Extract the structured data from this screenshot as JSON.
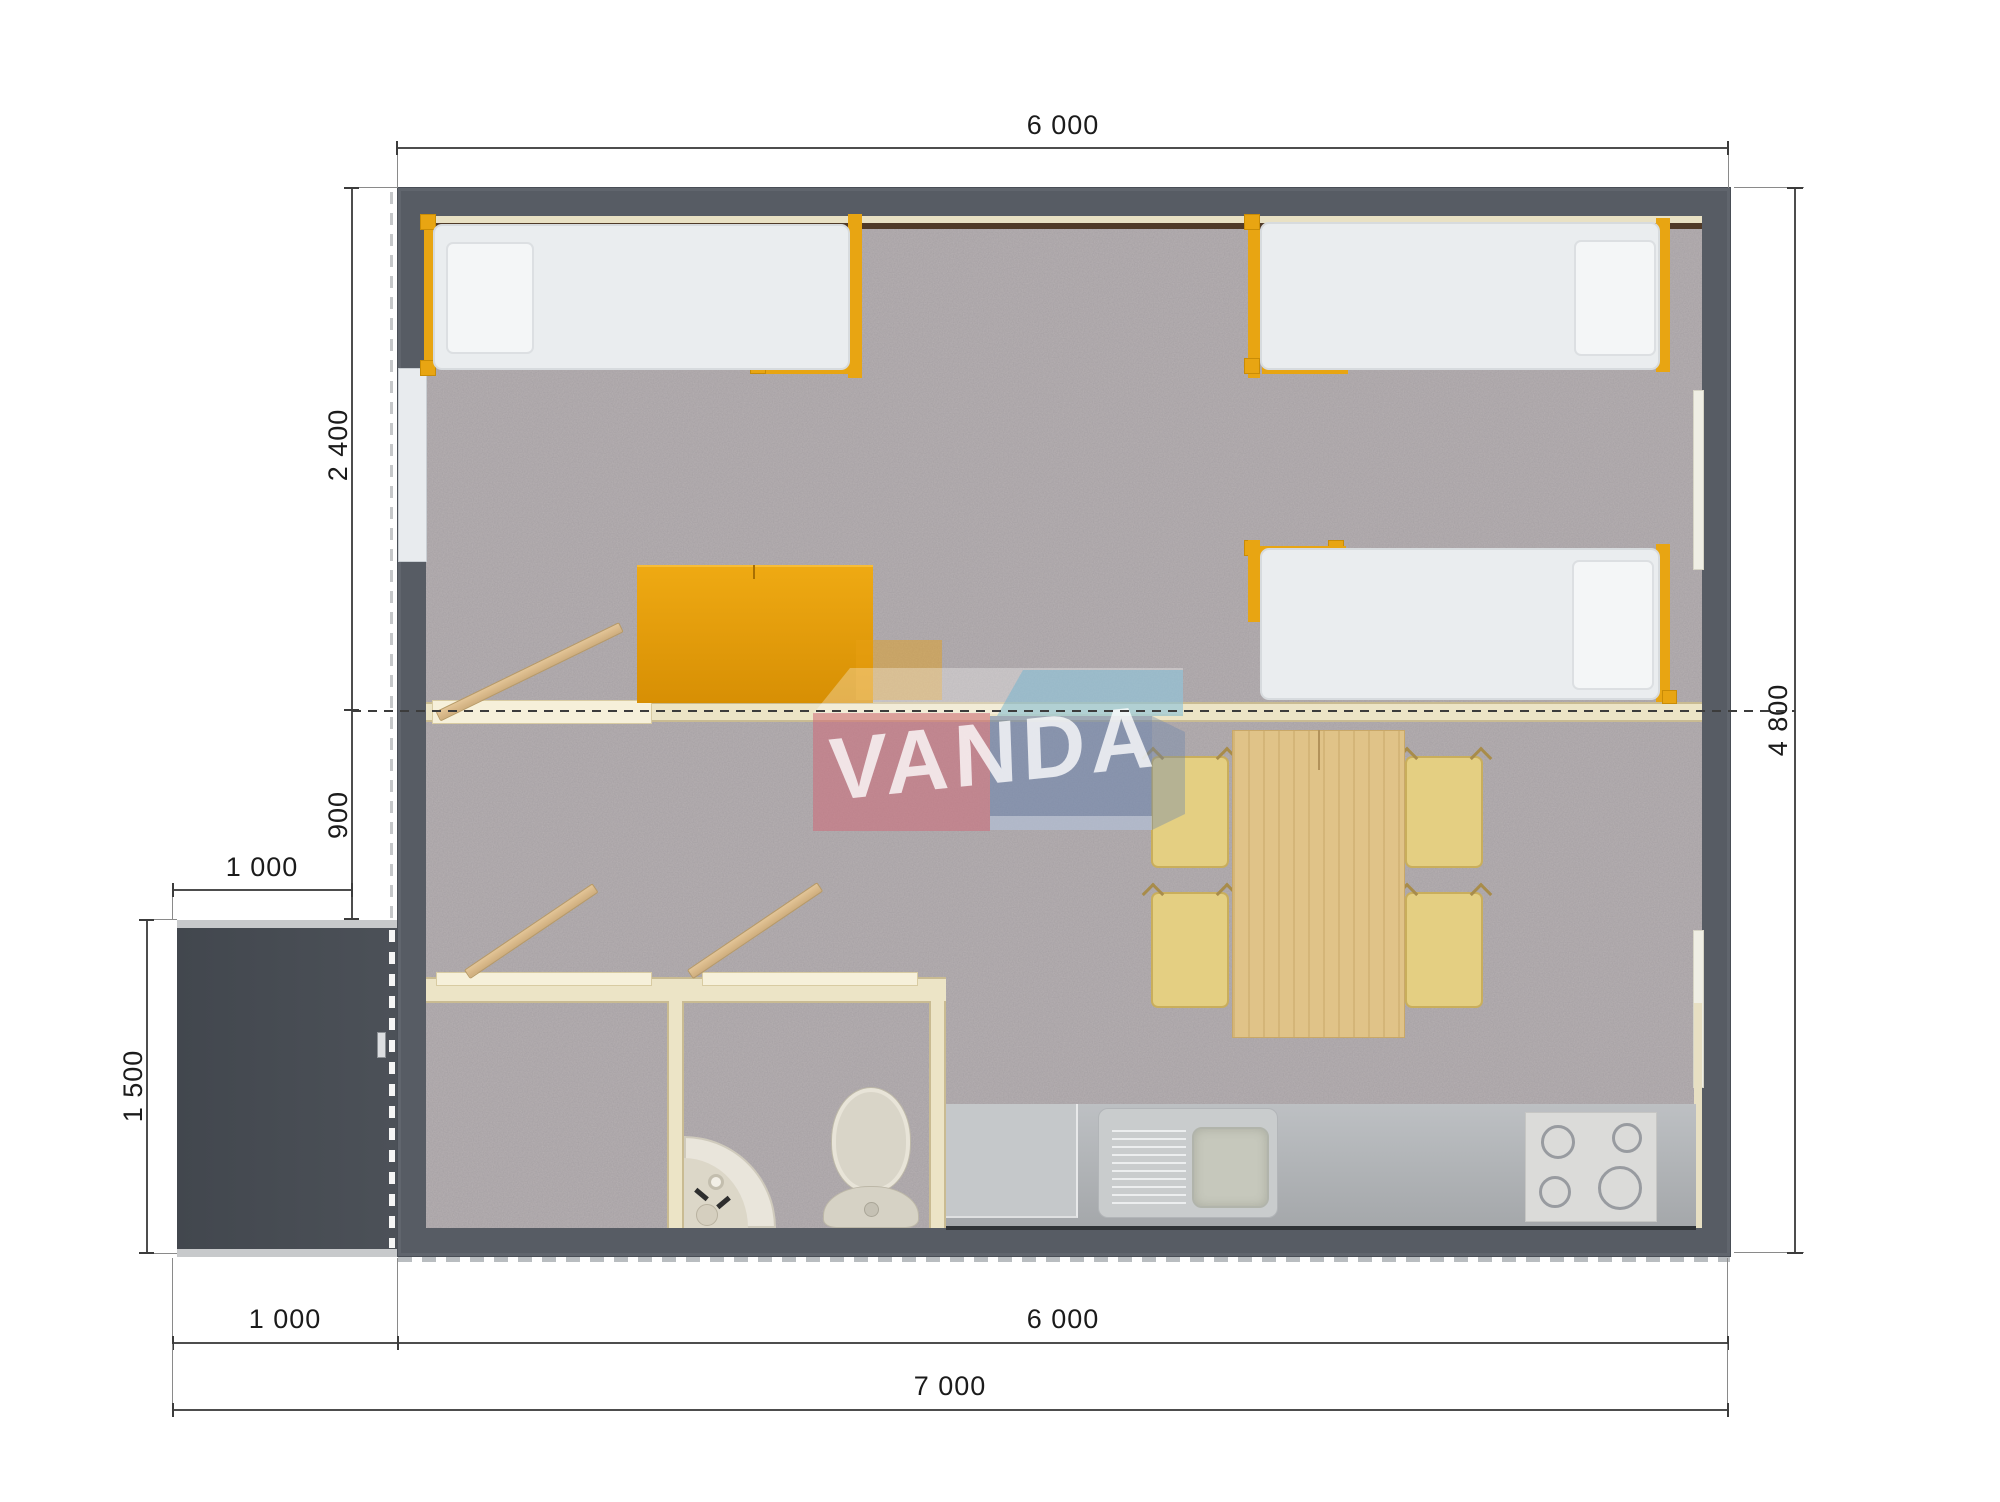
{
  "watermark": {
    "brand": "VANDA"
  },
  "dimensions": {
    "house_width_top": "6 000",
    "bedroom_depth": "2 400",
    "hallway_depth": "900",
    "porch_width": "1 000",
    "porch_depth": "1 500",
    "house_depth": "4 800",
    "porch_width_bottom": "1 000",
    "house_width_bottom": "6 000",
    "total_width": "7 000"
  },
  "colors": {
    "wall": "#575c64",
    "carpet": "#b7b1b3",
    "accent_orange": "#e8a512",
    "wood": "#d9b98c",
    "partition_cream": "#ece4c6",
    "counter_gray": "#b9bcbf",
    "porch_gray": "#4a4f56",
    "watermark_pink": "#d06a75",
    "watermark_blue": "#6e86ad",
    "watermark_teal": "#6fb3cf"
  }
}
